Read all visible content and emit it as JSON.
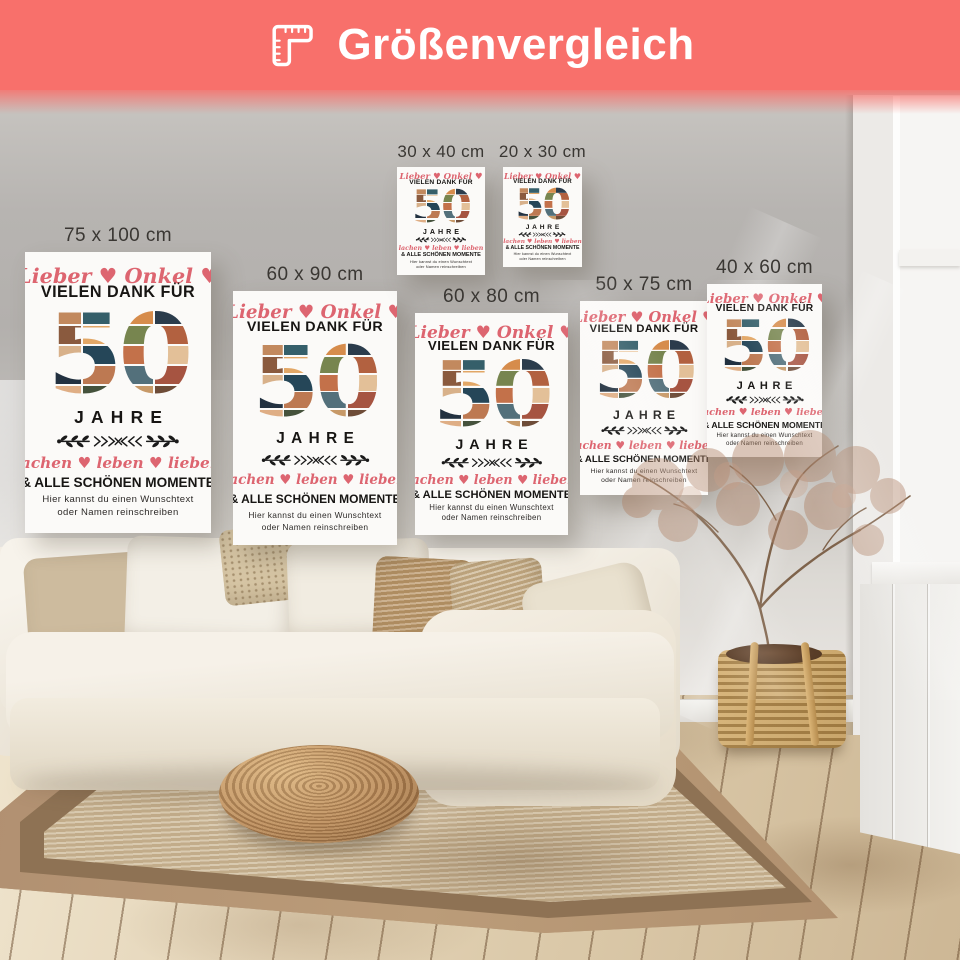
{
  "banner": {
    "title": "Größenvergleich",
    "icon": "ruler-icon",
    "bg_color": "#f8706b",
    "text_color": "#ffffff"
  },
  "posters": [
    {
      "label": "75 x 100 cm"
    },
    {
      "label": "60 x 90 cm"
    },
    {
      "label": "30 x 40 cm"
    },
    {
      "label": "20 x 30 cm"
    },
    {
      "label": "60 x 80 cm"
    },
    {
      "label": "50 x 75 cm"
    },
    {
      "label": "40 x 60 cm"
    }
  ],
  "poster_design": {
    "script_top": "Lieber ♥ Onkel ♥",
    "thanks_line": "VIELEN DANK FÜR",
    "number": "50",
    "years_line": "JAHRE",
    "divider_icon": "laurel-divider-icon",
    "script_bottom": "lachen ♥ leben ♥ lieben",
    "moments_line": "& ALLE SCHÖNEN MOMENTE",
    "note_line1": "Hier kannst du einen Wunschtext",
    "note_line2": "oder Namen reinschreiben",
    "accent_color": "#dd6570",
    "text_color": "#171513"
  },
  "scene": {
    "decor": [
      "sofa",
      "pillows",
      "rattan-pouf",
      "jute-rug",
      "wood-floor",
      "dried-plant",
      "wicker-basket",
      "window",
      "radiator-cabinet"
    ]
  }
}
